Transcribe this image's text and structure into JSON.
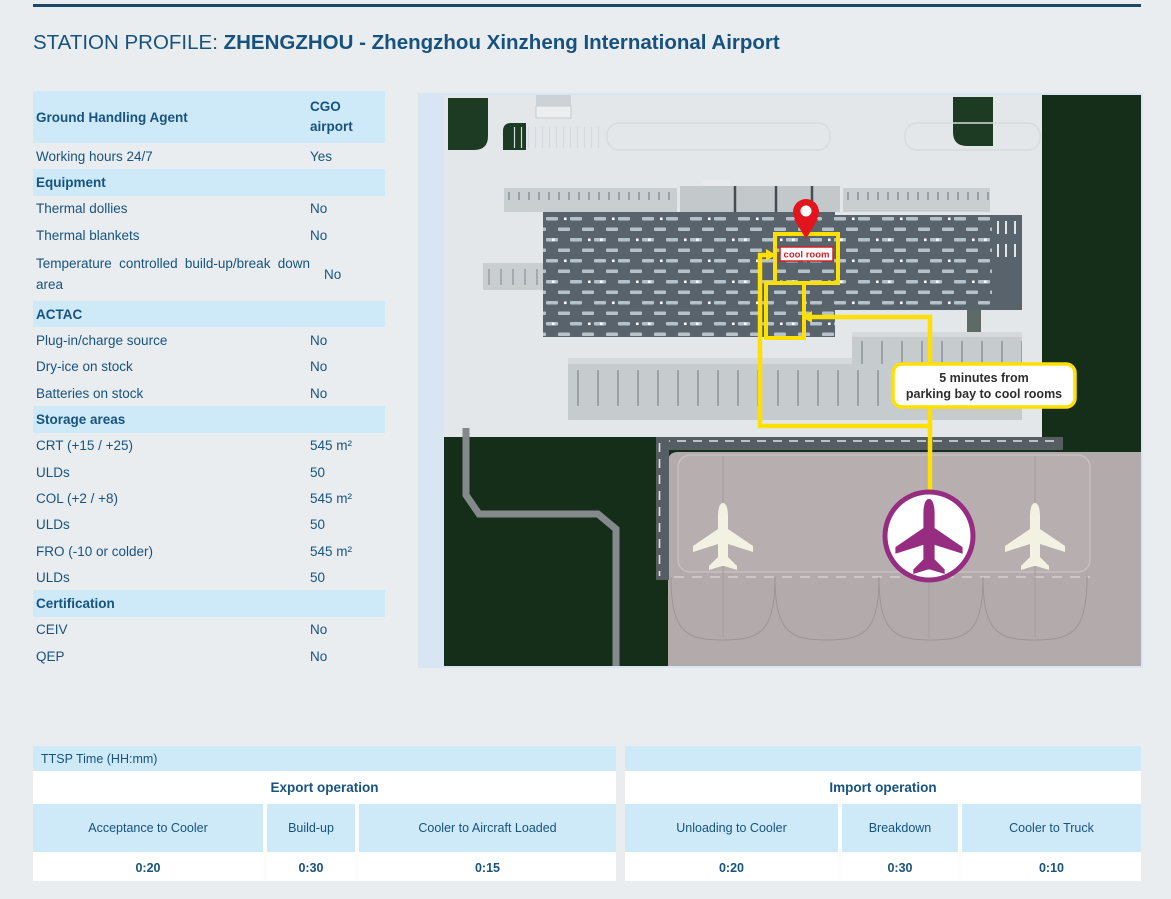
{
  "page": {
    "title_prefix": "STATION PROFILE: ",
    "title_name": "ZHENGZHOU - Zhengzhou Xinzheng International Airport"
  },
  "colors": {
    "text_blue": "#175380",
    "header_light_blue": "#cee9f7",
    "top_rule_navy": "#1e4766",
    "map_green": "#142e19",
    "route_yellow": "#ffe000",
    "pin_red": "#e2151e",
    "plane_purple": "#962d81"
  },
  "info_table": {
    "header": {
      "label": "Ground Handling Agent",
      "value": "CGO airport"
    },
    "rows": [
      {
        "type": "data",
        "label": "Working hours 24/7",
        "value": "Yes"
      },
      {
        "type": "section",
        "label": "Equipment"
      },
      {
        "type": "data",
        "label": "Thermal dollies",
        "value": "No"
      },
      {
        "type": "data",
        "label": "Thermal blankets",
        "value": "No"
      },
      {
        "type": "data",
        "tall": true,
        "label": "Temperature controlled build-up/break down area",
        "value": "No"
      },
      {
        "type": "section",
        "label": "ACTAC"
      },
      {
        "type": "data",
        "label": "Plug-in/charge source",
        "value": "No"
      },
      {
        "type": "data",
        "label": "Dry-ice on stock",
        "value": "No"
      },
      {
        "type": "data",
        "label": "Batteries on stock",
        "value": "No"
      },
      {
        "type": "section",
        "label": "Storage areas"
      },
      {
        "type": "data",
        "label": "CRT (+15 / +25)",
        "value": "545 m²"
      },
      {
        "type": "data",
        "label": "ULDs",
        "value": "50"
      },
      {
        "type": "data",
        "label": "COL (+2 / +8)",
        "value": "545 m²"
      },
      {
        "type": "data",
        "label": "ULDs",
        "value": "50"
      },
      {
        "type": "data",
        "label": "FRO (-10 or colder)",
        "value": "545 m²"
      },
      {
        "type": "data",
        "label": "ULDs",
        "value": "50"
      },
      {
        "type": "section",
        "label": "Certification"
      },
      {
        "type": "data",
        "label": "CEIV",
        "value": "No"
      },
      {
        "type": "data",
        "label": "QEP",
        "value": "No"
      }
    ]
  },
  "map": {
    "pin_label": "cool room",
    "callout_line1": "5 minutes from",
    "callout_line2": "parking bay to cool rooms"
  },
  "ttsp": {
    "title": "TTSP Time (HH:mm)",
    "export": {
      "title": "Export operation",
      "columns": [
        {
          "label": "Acceptance to Cooler",
          "value": "0:20"
        },
        {
          "label": "Build-up",
          "value": "0:30"
        },
        {
          "label": "Cooler to Aircraft Loaded",
          "value": "0:15"
        }
      ]
    },
    "import": {
      "title": "Import operation",
      "columns": [
        {
          "label": "Unloading to Cooler",
          "value": "0:20"
        },
        {
          "label": "Breakdown",
          "value": "0:30"
        },
        {
          "label": "Cooler to Truck",
          "value": "0:10"
        }
      ]
    }
  }
}
